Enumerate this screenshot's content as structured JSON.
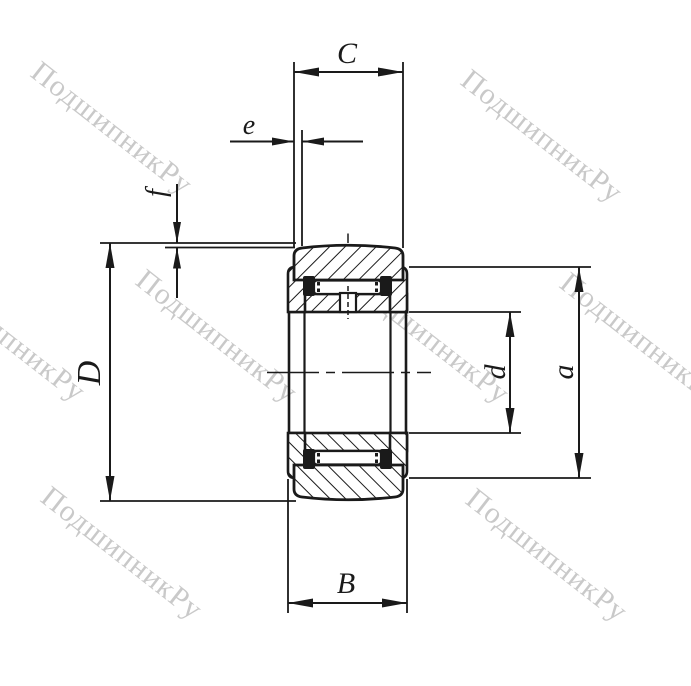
{
  "drawing": {
    "title": "bearing cross-section technical drawing",
    "labels": {
      "C": "C",
      "e": "e",
      "f": "f",
      "D": "D",
      "B": "B",
      "d": "d",
      "a": "a"
    },
    "watermark": {
      "text": "ПодшипникРу",
      "color": "#c9c9c9"
    },
    "colors": {
      "line": "#1a1a1a",
      "background": "#ffffff"
    }
  }
}
